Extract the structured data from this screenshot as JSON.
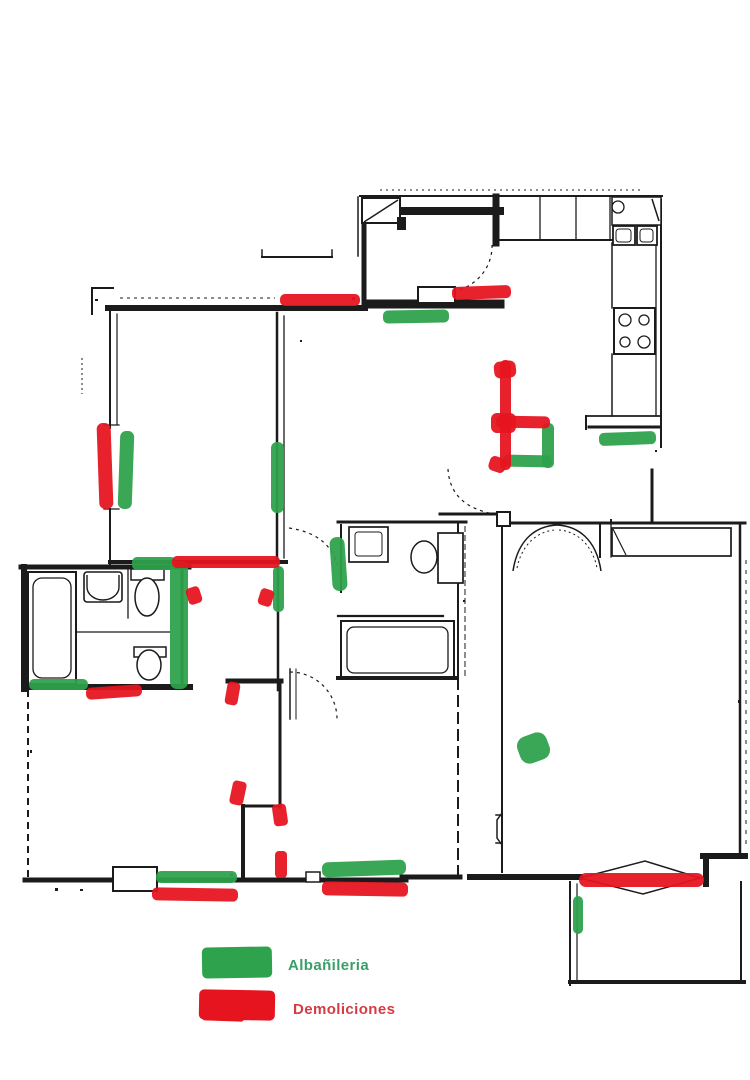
{
  "canvas": {
    "width": 750,
    "height": 1080,
    "background": "#ffffff"
  },
  "legend": {
    "items": [
      {
        "id": "albanileria",
        "label": "Albañileria",
        "color": "#2ea24c",
        "label_color": "#3a9e68",
        "swatch": {
          "x": 202,
          "y": 947,
          "w": 70,
          "h": 31,
          "rot": -1
        },
        "label_pos": {
          "x": 288,
          "y": 957
        }
      },
      {
        "id": "demoliciones",
        "label": "Demoliciones",
        "color": "#e5141f",
        "label_color": "#d53b42",
        "swatch": {
          "x": 199,
          "y": 990,
          "w": 76,
          "h": 30,
          "rot": 1
        },
        "swatch_tail": {
          "x": 202,
          "y": 1012,
          "w": 42,
          "h": 9,
          "rot": 2
        },
        "label_pos": {
          "x": 293,
          "y": 1001
        }
      }
    ]
  },
  "plan": {
    "ink": "#1b1b1b",
    "wall_segments": [
      [
        380,
        190,
        640,
        190,
        1,
        "2,4"
      ],
      [
        360,
        196,
        662,
        196,
        2
      ],
      [
        358,
        197,
        358,
        256,
        1.5
      ],
      [
        364,
        222,
        364,
        304,
        5
      ],
      [
        405,
        211,
        500,
        211,
        8
      ],
      [
        496,
        197,
        496,
        243,
        7
      ],
      [
        497,
        240,
        614,
        240,
        2
      ],
      [
        540,
        196,
        540,
        240,
        1.3
      ],
      [
        576,
        196,
        576,
        240,
        1.3
      ],
      [
        610,
        196,
        610,
        240,
        1.3
      ],
      [
        612,
        243,
        612,
        308,
        1.5
      ],
      [
        612,
        354,
        612,
        416,
        1.5
      ],
      [
        656,
        243,
        656,
        416,
        1.3
      ],
      [
        661,
        200,
        661,
        447,
        2
      ],
      [
        586,
        416,
        661,
        416,
        1.8
      ],
      [
        589,
        427,
        660,
        427,
        3
      ],
      [
        586,
        416,
        586,
        429,
        2
      ],
      [
        368,
        304,
        500,
        304,
        9
      ],
      [
        652,
        470,
        652,
        521,
        3
      ],
      [
        262,
        257,
        332,
        257,
        2
      ],
      [
        262,
        250,
        262,
        257,
        1.5
      ],
      [
        332,
        250,
        332,
        257,
        1.5
      ],
      [
        108,
        308,
        365,
        308,
        6
      ],
      [
        120,
        298,
        275,
        298,
        1,
        "3,4"
      ],
      [
        92,
        288,
        113,
        288,
        2
      ],
      [
        92,
        288,
        92,
        314,
        2
      ],
      [
        82,
        358,
        82,
        394,
        1,
        "2,3"
      ],
      [
        110,
        308,
        110,
        428,
        2
      ],
      [
        117,
        314,
        117,
        424,
        1.2
      ],
      [
        104,
        425,
        119,
        425,
        1.3
      ],
      [
        104,
        509,
        119,
        509,
        1.3
      ],
      [
        110,
        509,
        110,
        564,
        2
      ],
      [
        277,
        313,
        277,
        561,
        2.5
      ],
      [
        284,
        316,
        284,
        558,
        1.3
      ],
      [
        110,
        562,
        286,
        562,
        4
      ],
      [
        21,
        567,
        189,
        567,
        5
      ],
      [
        24,
        567,
        24,
        689,
        6
      ],
      [
        24,
        687,
        190,
        687,
        6
      ],
      [
        182,
        567,
        182,
        688,
        3
      ],
      [
        128,
        567,
        128,
        618,
        1.3
      ],
      [
        77,
        632,
        170,
        632,
        1.2
      ],
      [
        278,
        567,
        278,
        690,
        2.5
      ],
      [
        228,
        681,
        281,
        681,
        5
      ],
      [
        280,
        681,
        280,
        807,
        3
      ],
      [
        243,
        806,
        280,
        806,
        3
      ],
      [
        243,
        806,
        243,
        879,
        4
      ],
      [
        290,
        669,
        290,
        719,
        1.5
      ],
      [
        296,
        669,
        296,
        719,
        1
      ],
      [
        338,
        522,
        466,
        522,
        3
      ],
      [
        341,
        525,
        341,
        592,
        2
      ],
      [
        338,
        616,
        443,
        616,
        2.2
      ],
      [
        338,
        678,
        456,
        678,
        4
      ],
      [
        458,
        522,
        458,
        678,
        2
      ],
      [
        465,
        526,
        465,
        676,
        1,
        "6,3"
      ],
      [
        458,
        678,
        458,
        877,
        2,
        "12,5"
      ],
      [
        402,
        877,
        460,
        877,
        5
      ],
      [
        502,
        527,
        502,
        872,
        2
      ],
      [
        496,
        815,
        502,
        815,
        1.5
      ],
      [
        496,
        843,
        502,
        843,
        1.5
      ],
      [
        440,
        514,
        497,
        514,
        3
      ],
      [
        510,
        523,
        745,
        523,
        3
      ],
      [
        600,
        525,
        600,
        557,
        2
      ],
      [
        611,
        525,
        611,
        557,
        1.3
      ],
      [
        740,
        523,
        740,
        855,
        2.5
      ],
      [
        746,
        560,
        746,
        850,
        1,
        "4,6"
      ],
      [
        470,
        877,
        580,
        877,
        6
      ],
      [
        703,
        856,
        745,
        856,
        6
      ],
      [
        706,
        856,
        706,
        884,
        6
      ],
      [
        570,
        882,
        570,
        985,
        2
      ],
      [
        577,
        884,
        577,
        983,
        1.2
      ],
      [
        570,
        982,
        744,
        982,
        4
      ],
      [
        741,
        882,
        741,
        982,
        2
      ],
      [
        28,
        690,
        28,
        882,
        2,
        "7,5"
      ],
      [
        25,
        880,
        113,
        880,
        5
      ],
      [
        113,
        880,
        157,
        880,
        1
      ],
      [
        157,
        880,
        312,
        880,
        5
      ],
      [
        320,
        880,
        406,
        880,
        5
      ]
    ],
    "panels": [
      [
        362,
        198,
        38,
        25,
        2
      ],
      [
        418,
        287,
        37,
        16,
        2
      ],
      [
        612,
        197,
        49,
        28,
        1.5
      ],
      [
        613,
        226,
        22,
        19,
        1.8
      ],
      [
        637,
        226,
        20,
        19,
        1.8
      ],
      [
        614,
        308,
        41,
        46,
        2
      ],
      [
        438,
        533,
        25,
        50,
        1.7
      ],
      [
        497,
        512,
        13,
        14,
        2
      ],
      [
        113,
        867,
        44,
        24,
        2
      ],
      [
        306,
        872,
        14,
        10,
        1.5
      ]
    ],
    "boxes": [
      [
        616,
        229,
        15,
        13,
        1,
        3
      ],
      [
        640,
        229,
        13,
        13,
        1,
        3
      ],
      [
        28,
        572,
        48,
        112,
        2
      ],
      [
        33,
        578,
        38,
        100,
        1.3,
        9
      ],
      [
        84,
        572,
        38,
        30,
        1.6,
        3
      ],
      [
        131,
        569,
        33,
        11,
        1.5
      ],
      [
        134,
        647,
        32,
        10,
        1.5
      ],
      [
        349,
        527,
        39,
        35,
        1.7
      ],
      [
        355,
        532,
        27,
        24,
        1,
        3
      ],
      [
        341,
        621,
        113,
        57,
        2
      ],
      [
        347,
        627,
        101,
        46,
        1.3,
        7
      ],
      [
        612,
        528,
        119,
        28,
        1.7
      ]
    ],
    "filled_boxes": [
      [
        397,
        217,
        9,
        13
      ],
      [
        352,
        297,
        3,
        3
      ],
      [
        95,
        299,
        3,
        2
      ],
      [
        610,
        519,
        2,
        3
      ],
      [
        463,
        600,
        2,
        2
      ],
      [
        738,
        700,
        3,
        3
      ],
      [
        230,
        874,
        3,
        2
      ],
      [
        655,
        450,
        2,
        2
      ],
      [
        30,
        750,
        2,
        3
      ],
      [
        300,
        340,
        2,
        2
      ],
      [
        55,
        888,
        3,
        3
      ],
      [
        80,
        889,
        3,
        2
      ]
    ],
    "circles": [
      [
        625,
        320,
        6,
        1.3
      ],
      [
        644,
        320,
        5,
        1.3
      ],
      [
        625,
        342,
        5,
        1.3
      ],
      [
        644,
        342,
        6,
        1.3
      ],
      [
        618,
        207,
        6,
        1.3
      ],
      [
        425,
        556,
        4,
        1.2
      ]
    ],
    "ellipses": [
      [
        147,
        597,
        12,
        19,
        1.5
      ],
      [
        149,
        665,
        12,
        15,
        1.5
      ],
      [
        424,
        557,
        13,
        16,
        1.5
      ]
    ],
    "curves": [
      {
        "d": "M492,245 A48,46 0 0 1 455,291",
        "w": 1.2,
        "dash": "3,4"
      },
      {
        "d": "M448,469 Q450,506 494,514",
        "w": 1.2,
        "dash": "3,4"
      },
      {
        "d": "M290,672 A47,47 0 0 1 337,719",
        "w": 1.2,
        "dash": "3,4"
      },
      {
        "d": "M289,528 Q332,534 339,571",
        "w": 1.2,
        "dash": "3,4"
      },
      {
        "d": "M513,571 C518,538 537,526 557,525",
        "w": 1.5
      },
      {
        "d": "M557,525 C577,526 596,538 601,571",
        "w": 1.5
      },
      {
        "d": "M517,568 C522,543 539,531 555,530",
        "w": 1,
        "dash": "2,3"
      },
      {
        "d": "M559,530 C575,531 592,543 597,568",
        "w": 1,
        "dash": "2,3"
      },
      {
        "d": "M580,878 L645,861 L700,878 L643,894 Z",
        "w": 1.5
      },
      {
        "d": "M652,199 L659,221",
        "w": 1.5
      },
      {
        "d": "M364,222 L398,200",
        "w": 1.5
      },
      {
        "d": "M613,529 L626,555",
        "w": 1.2
      },
      {
        "d": "M87,575 v12 a16,13 0 0 0 32,0 v-12",
        "w": 1.4
      },
      {
        "d": "M502,813 L497,820 L497,838 L502,845",
        "w": 1.5
      }
    ]
  },
  "annotations": {
    "masonry": {
      "id": "albanileria",
      "color": "#2ea24c",
      "marks": [
        [
          383,
          310,
          66,
          13,
          -1,
          5
        ],
        [
          599,
          432,
          57,
          13,
          -2,
          5
        ],
        [
          542,
          423,
          12,
          45,
          0,
          5
        ],
        [
          503,
          455,
          49,
          12,
          1,
          5
        ],
        [
          119,
          431,
          14,
          78,
          2,
          6
        ],
        [
          271,
          442,
          13,
          71,
          0,
          6
        ],
        [
          132,
          557,
          44,
          13,
          0,
          5
        ],
        [
          170,
          561,
          18,
          128,
          0,
          7
        ],
        [
          273,
          566,
          11,
          46,
          0,
          5
        ],
        [
          331,
          537,
          15,
          54,
          -4,
          7
        ],
        [
          29,
          679,
          59,
          11,
          0,
          5
        ],
        [
          156,
          871,
          81,
          12,
          0,
          5
        ],
        [
          322,
          861,
          84,
          15,
          -2,
          6
        ],
        [
          518,
          734,
          31,
          28,
          -20,
          10
        ],
        [
          573,
          896,
          10,
          38,
          0,
          5
        ]
      ]
    },
    "demolition": {
      "id": "demoliciones",
      "color": "#e5141f",
      "marks": [
        [
          280,
          294,
          80,
          12,
          0,
          5
        ],
        [
          452,
          286,
          59,
          13,
          -2,
          5
        ],
        [
          500,
          360,
          11,
          110,
          0,
          5
        ],
        [
          494,
          361,
          22,
          17,
          -6,
          6
        ],
        [
          491,
          413,
          25,
          20,
          0,
          6
        ],
        [
          489,
          457,
          17,
          15,
          18,
          5
        ],
        [
          496,
          416,
          54,
          12,
          1,
          5
        ],
        [
          98,
          423,
          14,
          86,
          -2,
          6
        ],
        [
          172,
          556,
          108,
          12,
          0,
          5
        ],
        [
          187,
          587,
          14,
          17,
          -18,
          4
        ],
        [
          259,
          589,
          14,
          17,
          18,
          4
        ],
        [
          86,
          686,
          56,
          12,
          -4,
          5
        ],
        [
          226,
          682,
          13,
          23,
          10,
          4
        ],
        [
          231,
          781,
          14,
          24,
          12,
          4
        ],
        [
          273,
          804,
          14,
          22,
          -8,
          4
        ],
        [
          275,
          851,
          12,
          27,
          0,
          4
        ],
        [
          152,
          888,
          86,
          13,
          1,
          5
        ],
        [
          322,
          882,
          86,
          14,
          1,
          5
        ],
        [
          579,
          873,
          125,
          14,
          0,
          7
        ]
      ]
    }
  }
}
